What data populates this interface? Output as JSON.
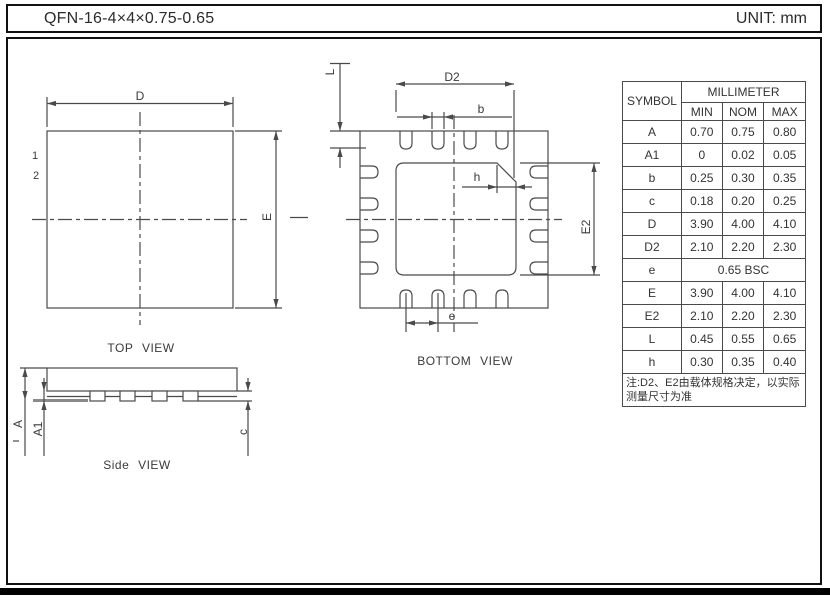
{
  "header": {
    "title": "QFN-16-4×4×0.75-0.65",
    "unit": "UNIT: mm"
  },
  "colors": {
    "line": "#4a4a4a",
    "text": "#333333",
    "seating_plane_line": "#8a8a8a",
    "footer_bar": "#000000"
  },
  "views": {
    "top": {
      "caption": "TOP VIEW",
      "pin1": "1",
      "pin2": "2",
      "dim_d": "D",
      "dim_e": "E"
    },
    "bottom": {
      "caption": "BOTTOM VIEW",
      "dim_d2": "D2",
      "dim_b": "b",
      "dim_l": "L",
      "dim_h": "h",
      "dim_e2": "E2",
      "dim_e": "e"
    },
    "side": {
      "caption": "Side VIEW",
      "dim_a": "A",
      "dim_a1": "A1",
      "dim_c": "c"
    }
  },
  "table": {
    "symbol_header": "SYMBOL",
    "unit_header": "MILLIMETER",
    "sub_headers": [
      "MIN",
      "NOM",
      "MAX"
    ],
    "rows": [
      {
        "symbol": "A",
        "min": "0.70",
        "nom": "0.75",
        "max": "0.80"
      },
      {
        "symbol": "A1",
        "min": "0",
        "nom": "0.02",
        "max": "0.05"
      },
      {
        "symbol": "b",
        "min": "0.25",
        "nom": "0.30",
        "max": "0.35"
      },
      {
        "symbol": "c",
        "min": "0.18",
        "nom": "0.20",
        "max": "0.25"
      },
      {
        "symbol": "D",
        "min": "3.90",
        "nom": "4.00",
        "max": "4.10"
      },
      {
        "symbol": "D2",
        "min": "2.10",
        "nom": "2.20",
        "max": "2.30"
      },
      {
        "symbol": "e",
        "span": "0.65 BSC"
      },
      {
        "symbol": "E",
        "min": "3.90",
        "nom": "4.00",
        "max": "4.10"
      },
      {
        "symbol": "E2",
        "min": "2.10",
        "nom": "2.20",
        "max": "2.30"
      },
      {
        "symbol": "L",
        "min": "0.45",
        "nom": "0.55",
        "max": "0.65"
      },
      {
        "symbol": "h",
        "min": "0.30",
        "nom": "0.35",
        "max": "0.40"
      }
    ],
    "note_line1": "注:D2、E2由载体规格决定，以实际",
    "note_line2": "测量尺寸为准"
  }
}
